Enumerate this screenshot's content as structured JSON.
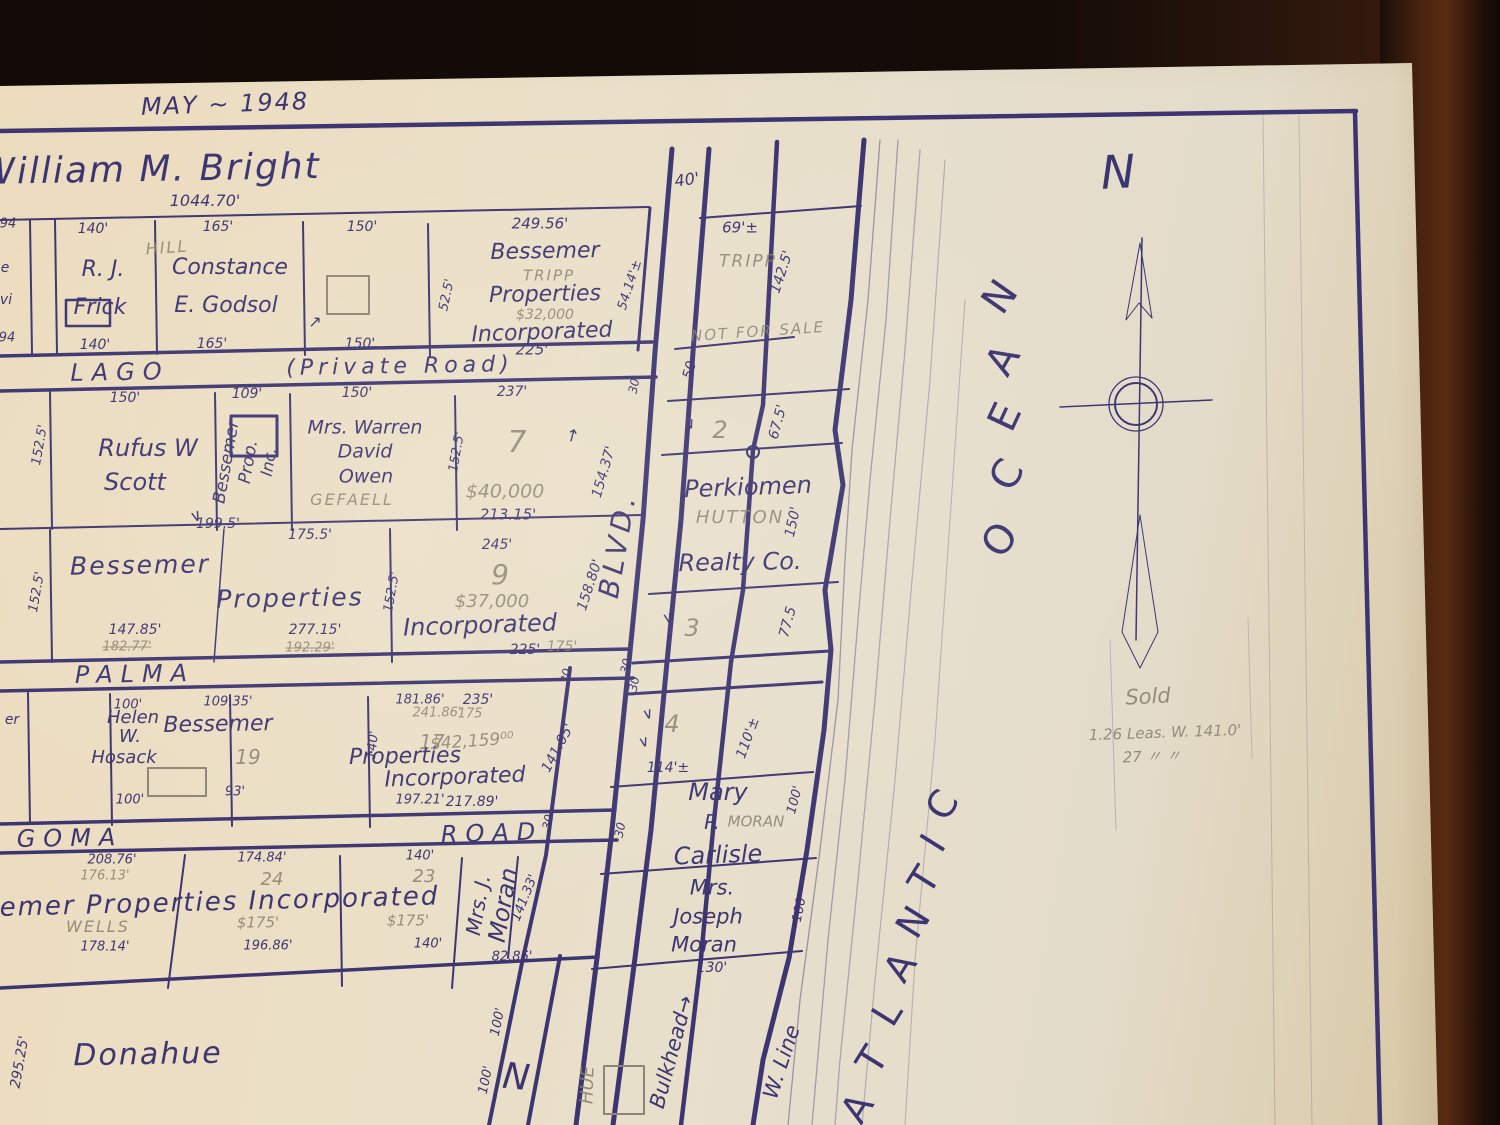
{
  "colors": {
    "ink": "#3d3571",
    "pencil": "#8d8577",
    "paper": "#e8dcc2",
    "wood": "#1d100a"
  },
  "header": {
    "date": "MAY ~ 1948"
  },
  "bright": {
    "name": "William M. Bright",
    "length": "1044.70'"
  },
  "symbols": {
    "vee": "∨",
    "arrow_up": "↑",
    "arrow_ne": "↗"
  },
  "row1": {
    "edge": {
      "t1": "94",
      "t2": "e",
      "t3": "vi",
      "t4": "94"
    },
    "frick": {
      "top": "140'",
      "pencil": "HILL",
      "l1": "R. J.",
      "l2": "Frick",
      "bottom": "140'"
    },
    "godsol": {
      "top": "165'",
      "l1": "Constance",
      "l2": "E. Godsol",
      "bottom": "165'"
    },
    "vacant": {
      "top": "150'",
      "bottom": "150'"
    },
    "bessemer": {
      "top": "249.56'",
      "side": "52.5'",
      "l1": "Bessemer",
      "pencil1": "TRIPP",
      "l2": "Properties",
      "pencil2": "$32,000",
      "l3": "Incorporated",
      "bottom": "225'",
      "east": "54.14'±"
    }
  },
  "roads": {
    "lago": "LAGO",
    "lago_suffix": "(Private Road)",
    "palma": "PALMA",
    "algoma": "GOMA",
    "road": "ROAD",
    "blvd": "BLVD."
  },
  "row2": {
    "side": "152.5'",
    "scott": {
      "top": "150'",
      "l1": "Rufus W",
      "l2": "Scott"
    },
    "bprop": {
      "top": "109'",
      "l1": "Bessemer",
      "l2": "Prop.",
      "l3": "Inc."
    },
    "owen": {
      "top": "150'",
      "l1": "Mrs. Warren",
      "l2": "David",
      "l3": "Owen",
      "pencil": "GEFAELL",
      "side": "152.5'"
    },
    "lot7": {
      "top": "237'",
      "num": "7",
      "price": "$40,000",
      "bottom": "213.15'"
    },
    "blvd_len": "154.37'"
  },
  "row3": {
    "side": "152.5'",
    "len1": "199.5'",
    "len2": "175.5'",
    "l1": "Bessemer",
    "l2": "Properties",
    "l3": "Incorporated",
    "mid_side": "152.5'",
    "lot9": {
      "top": "245'",
      "num": "9",
      "price": "$37,000"
    },
    "b1": "147.85'",
    "b1p": "182.77'",
    "b2": "277.15'",
    "b2p": "192.29'",
    "b3": "225'",
    "b3p": "175'",
    "blvd_len": "158.80'"
  },
  "row4": {
    "edge": "er",
    "hosack": {
      "top": "100'",
      "l1": "Helen",
      "l2": "W.",
      "l3": "Hosack",
      "bottom": "100'"
    },
    "lot19": {
      "top": "109.35'",
      "num": "19",
      "name": "Bessemer",
      "bottom": "93'"
    },
    "lot17": {
      "top": "181.86'",
      "top_pencil": "241.86'",
      "num": "17",
      "name": "Properties",
      "bottom": "197.21'",
      "side": "140'"
    },
    "lotinc": {
      "top": "235'",
      "top_pencil": "175",
      "price": "$42,159⁰⁰",
      "name": "Incorporated",
      "bottom": "217.89'",
      "diag": "141.05'"
    }
  },
  "row5": {
    "lota": {
      "top": "208.76'",
      "top_pencil": "176.13'",
      "pencil": "WELLS",
      "bottom": "178.14'"
    },
    "name_line": "Bessemer Properties Incorporated",
    "lot24": {
      "top": "174.84'",
      "num": "24",
      "price": "$175'",
      "bottom": "196.86'"
    },
    "lot23": {
      "top": "140'",
      "num": "23",
      "price": "$175'",
      "bottom": "140'"
    },
    "moran": {
      "l1": "Mrs. J.",
      "l2": "Moran",
      "diag": "141.33'",
      "bottom": "82.86'"
    }
  },
  "blvd_marks": {
    "m40": "40'",
    "m50": "50",
    "m30": "30"
  },
  "east": {
    "tripp": {
      "front": "69'±",
      "pencil": "TRIPP",
      "depth": "142.5'",
      "note": "NOT FOR SALE"
    },
    "lot2": {
      "num": "2",
      "depth": "67.5'"
    },
    "perkiomen": {
      "l1": "Perkiomen",
      "pencil": "HUTTON",
      "l2": "Realty Co.",
      "depth": "150'"
    },
    "lot3": {
      "num": "3",
      "depth": "77.5"
    },
    "lot4": {
      "num": "4",
      "front": "114'±",
      "depth": "110'±"
    },
    "mary": {
      "l1": "Mary",
      "l2": "P.",
      "pencil": "MORAN",
      "depth": "100'",
      "l3": "Carlisle"
    },
    "jmoran": {
      "l1": "Mrs.",
      "l2": "Joseph",
      "l3": "Moran",
      "front": "130'",
      "depth": "100'"
    },
    "bulkhead": "Bulkhead→",
    "wline": "W. Line"
  },
  "bottom": {
    "donahue": "Donahue",
    "edge_len": "295.25'",
    "len100a": "100'",
    "len100b": "100'",
    "street_letter": "N",
    "pencil_hue": "HUE"
  },
  "ocean": {
    "l1": "N",
    "l2": "A",
    "l3": "E",
    "l4": "C",
    "l5": "O"
  },
  "atlantic": {
    "l1": "C",
    "l2": "I",
    "l3": "T",
    "l4": "N",
    "l5": "A",
    "l6": "L",
    "l7": "T",
    "l8": "A"
  },
  "compass": {
    "north": "N"
  },
  "notes": {
    "sold": "Sold",
    "line2": "1.26 Leas. W. 141.0'",
    "line3": "27   〃    〃"
  }
}
